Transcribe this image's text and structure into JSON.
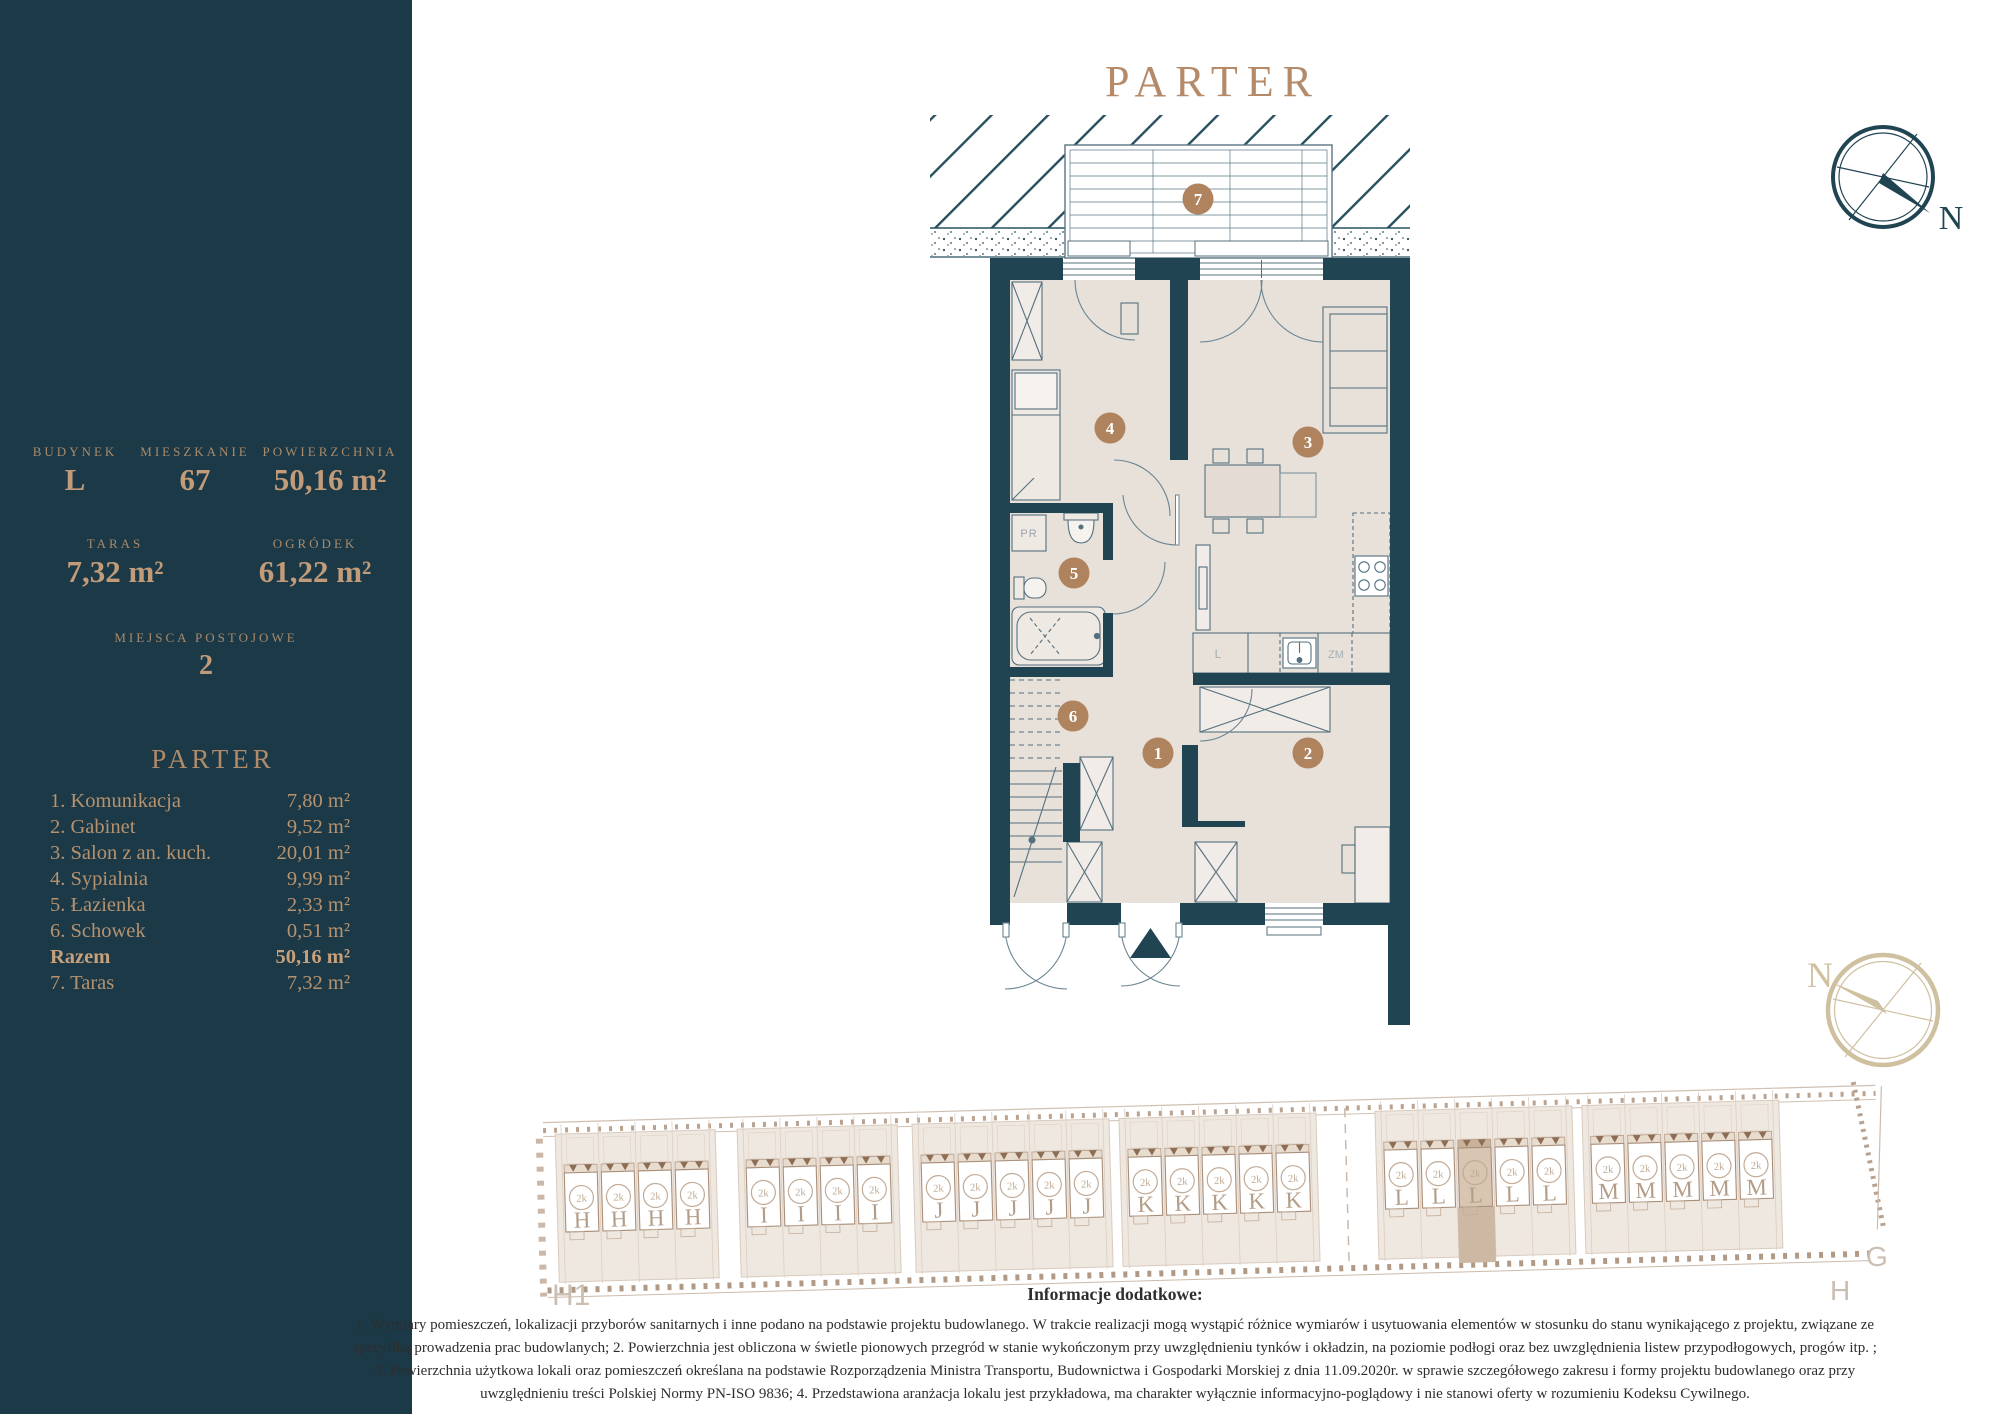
{
  "colors": {
    "sidebar_bg": "#1b3947",
    "wall_navy": "#204452",
    "floor_beige": "#e8e1da",
    "accent_tan": "#b58a69",
    "site_tan": "#c2ab97",
    "highlight_unit": "#d9c6b2"
  },
  "sidebar": {
    "stats": [
      {
        "label": "BUDYNEK",
        "value": "L"
      },
      {
        "label": "MIESZKANIE",
        "value": "67"
      },
      {
        "label": "POWIERZCHNIA",
        "value": "50,16 m²"
      }
    ],
    "stats2": [
      {
        "label": "TARAS",
        "value": "7,32 m²"
      },
      {
        "label": "OGRÓDEK",
        "value": "61,22 m²"
      }
    ],
    "parking_label": "MIEJSCA POSTOJOWE",
    "parking_value": "2",
    "list_title": "PARTER",
    "rooms": [
      {
        "name": "1. Komunikacja",
        "area": "7,80 m²"
      },
      {
        "name": "2. Gabinet",
        "area": "9,52 m²"
      },
      {
        "name": "3. Salon z an. kuch.",
        "area": "20,01 m²"
      },
      {
        "name": "4. Sypialnia",
        "area": "9,99 m²"
      },
      {
        "name": "5. Łazienka",
        "area": "2,33 m²"
      },
      {
        "name": "6. Schowek",
        "area": "0,51 m²"
      },
      {
        "name": "Razem",
        "area": "50,16 m²"
      },
      {
        "name": "7. Taras",
        "area": "7,32 m²"
      }
    ]
  },
  "plan": {
    "title": "PARTER",
    "markers": {
      "m1": "1",
      "m2": "2",
      "m3": "3",
      "m4": "4",
      "m5": "5",
      "m6": "6",
      "m7": "7"
    },
    "labels": {
      "pr": "PR",
      "fridge": "L",
      "dishwasher": "ZM"
    },
    "compass_top": "N",
    "compass_bottom": "N"
  },
  "siteplan": {
    "unit_badge": "2k",
    "groups": [
      {
        "letter": "H",
        "units": 4
      },
      {
        "letter": "I",
        "units": 4
      },
      {
        "letter": "J",
        "units": 5
      },
      {
        "letter": "K",
        "units": 5
      },
      {
        "letter": "L",
        "units": 5,
        "highlight": 2
      },
      {
        "letter": "M",
        "units": 5
      }
    ],
    "label_h1": "H1",
    "label_g": "G",
    "label_h": "H"
  },
  "notes": {
    "title": "Informacje dodatkowe:",
    "lines": [
      "1. Wymiary pomieszczeń, lokalizacji przyborów sanitarnych i inne podano na podstawie projektu budowlanego. W trakcie realizacji mogą wystąpić różnice wymiarów i usytuowania elementów w stosunku do stanu wynikającego z projektu, związane ze",
      "specyfiką prowadzenia prac budowlanych; 2. Powierzchnia jest obliczona w świetle pionowych przegród w stanie wykończonym przy uwzględnieniu tynków i okładzin, na poziomie podłogi oraz bez uwzględnienia listew przypodłogowych, progów itp. ;",
      "3. Powierzchnia użytkowa lokali oraz pomieszczeń określana na podstawie Rozporządzenia Ministra Transportu, Budownictwa i Gospodarki Morskiej z dnia 11.09.2020r. w sprawie szczegółowego zakresu i formy projektu budowlanego oraz przy",
      "uwzględnieniu treści Polskiej Normy PN-ISO 9836; 4. Przedstawiona aranżacja lokalu jest przykładowa, ma charakter wyłącznie informacyjno-poglądowy i nie stanowi oferty w rozumieniu Kodeksu Cywilnego."
    ]
  }
}
